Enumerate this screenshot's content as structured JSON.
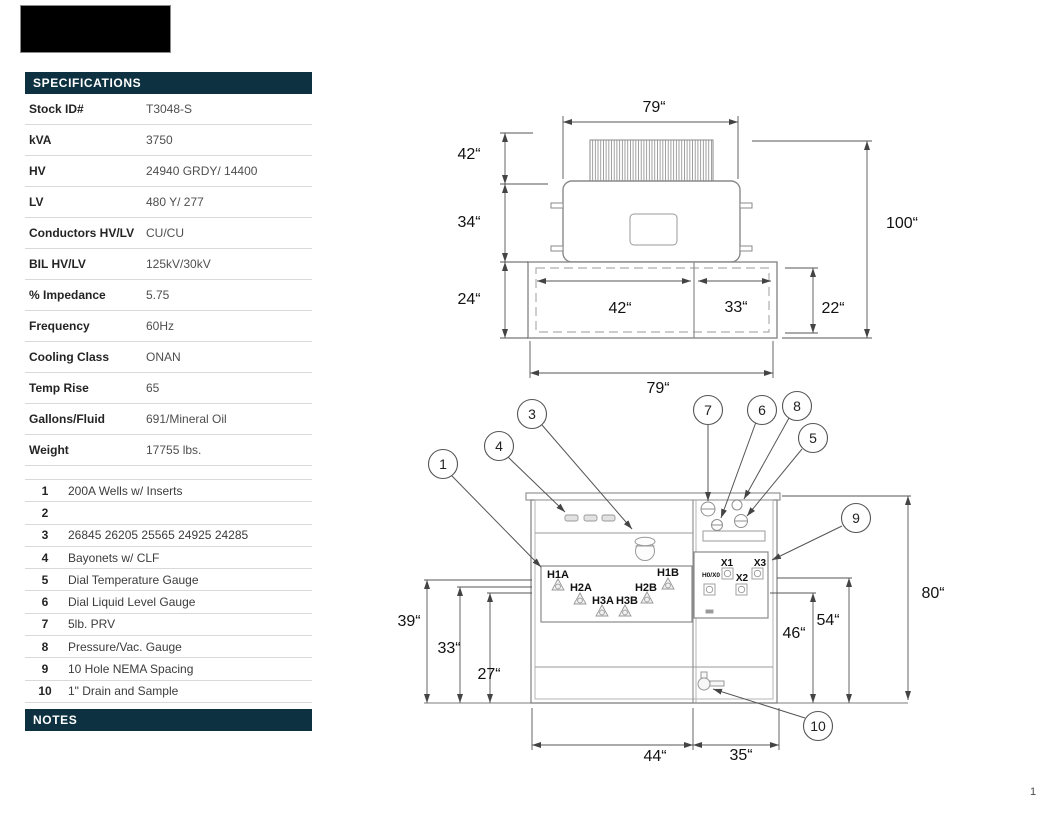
{
  "colors": {
    "header_bg": "#0d3140",
    "header_text": "#ffffff"
  },
  "page": {
    "number": "1"
  },
  "specifications": {
    "title": "SPECIFICATIONS",
    "rows": [
      {
        "label": "Stock ID#",
        "value": "T3048-S"
      },
      {
        "label": "kVA",
        "value": "3750"
      },
      {
        "label": "HV",
        "value": "24940 GRDY/ 14400"
      },
      {
        "label": "LV",
        "value": "480 Y/ 277"
      },
      {
        "label": "Conductors HV/LV",
        "value": "CU/CU"
      },
      {
        "label": "BIL HV/LV",
        "value": "125kV/30kV"
      },
      {
        "label": "% Impedance",
        "value": "5.75"
      },
      {
        "label": "Frequency",
        "value": "60Hz"
      },
      {
        "label": "Cooling Class",
        "value": "ONAN"
      },
      {
        "label": "Temp Rise",
        "value": "65"
      },
      {
        "label": "Gallons/Fluid",
        "value": "691/Mineral Oil"
      },
      {
        "label": "Weight",
        "value": "17755 lbs."
      }
    ]
  },
  "component_list": {
    "items": [
      {
        "num": "1",
        "text": "200A Wells w/ Inserts"
      },
      {
        "num": "2",
        "text": ""
      },
      {
        "num": "3",
        "text": "26845 26205 25565 24925 24285"
      },
      {
        "num": "4",
        "text": "Bayonets w/ CLF"
      },
      {
        "num": "5",
        "text": "Dial Temperature Gauge"
      },
      {
        "num": "6",
        "text": "Dial Liquid Level Gauge"
      },
      {
        "num": "7",
        "text": "5lb. PRV"
      },
      {
        "num": "8",
        "text": "Pressure/Vac. Gauge"
      },
      {
        "num": "9",
        "text": "10 Hole NEMA Spacing"
      },
      {
        "num": "10",
        "text": "1\" Drain and Sample"
      }
    ]
  },
  "notes": {
    "title": "NOTES"
  },
  "top_view": {
    "dims": {
      "top_width": "79“",
      "radiator_depth": "42“",
      "tank_depth": "34“",
      "cabinet_depth": "24“",
      "overall_depth": "100“",
      "hv_section_width": "42“",
      "lv_section_width": "33“",
      "cabinet_inner_depth": "22“",
      "bottom_width": "79“"
    }
  },
  "front_view": {
    "dims": {
      "h1_height": "39“",
      "h2_height": "33“",
      "h3_height": "27“",
      "overall_height": "80“",
      "lv_upper_height": "54“",
      "lv_lower_height": "46“",
      "hv_section_width": "44“",
      "lv_section_width": "35“"
    },
    "hv_bushings": [
      "H1A",
      "H2A",
      "H3A",
      "H3B",
      "H2B",
      "H1B"
    ],
    "lv_terminals": [
      "X1",
      "X3",
      "H0/X0",
      "X2"
    ],
    "callouts": [
      "1",
      "3",
      "4",
      "5",
      "6",
      "7",
      "8",
      "9",
      "10"
    ]
  }
}
